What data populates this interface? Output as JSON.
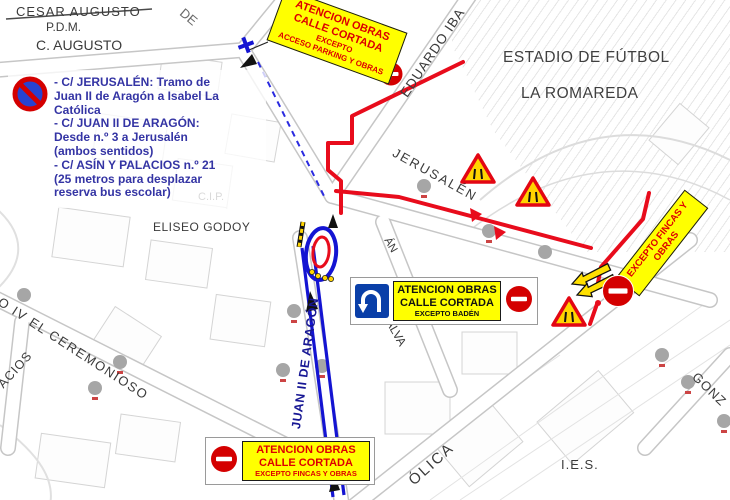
{
  "legend": {
    "lines": [
      "- C/ JERUSALÉN: Tramo de",
      "Juan II de Aragón a Isabel La",
      "Católica",
      "- C/ JUAN II DE ARAGÓN:",
      "Desde n.º 3 a Jerusalén",
      "(ambos sentidos)",
      "- C/ ASÍN Y PALACIOS n.º 21",
      "(25 metros para desplazar",
      "reserva bus escolar)"
    ]
  },
  "banners": {
    "top": {
      "line1": "ATENCION OBRAS",
      "line2": "CALLE CORTADA",
      "line3": "EXCEPTO",
      "line4": "ACCESO PARKING Y OBRAS"
    },
    "middle": {
      "line1": "ATENCION OBRAS",
      "line2": "CALLE CORTADA",
      "line3": "EXCEPTO BADÉN"
    },
    "bottom": {
      "line1": "ATENCION OBRAS",
      "line2": "CALLE CORTADA",
      "line3": "EXCEPTO FINCAS Y OBRAS"
    },
    "right": {
      "line1": "EXCEPTO FINCAS Y",
      "line2": "OBRAS"
    }
  },
  "map_labels": {
    "cesar_augusto": "CESAR AUGUSTO",
    "pdm": "P.D.M.",
    "c_augusto": "C. AUGUSTO",
    "de_fragment": "DE",
    "eduardo_ibarra": "EDUARDO IBA",
    "estadio_line1": "ESTADIO DE FÚTBOL",
    "estadio_line2": "LA ROMAREDA",
    "jerusalen": "JERUSALÉN",
    "cip": "C.I.P.",
    "eliseo_godoy": "ELISEO GODOY",
    "ceremonioso": "O IV EL CEREMONIOSO",
    "palacios": "ACIOS",
    "juan_ii": "JUAN II DE ARAGÓN",
    "alva": "ALVA",
    "azan": "ÁN",
    "catolica": "ÓLICA",
    "ies": "I.E.S.",
    "gonzalez": "GONZ"
  },
  "icons": {
    "no_parking": "no-parking-sign",
    "no_entry": "no-entry-sign",
    "u_turn": "u-turn-left-sign",
    "road_narrows": "road-narrows-warning-triangle",
    "detour": "detour-arrows"
  },
  "colors": {
    "closure_line_red": "#e80c1c",
    "route_blue": "#1414d2",
    "banner_yellow": "#ffff00",
    "banner_text_red": "#dd0000",
    "banner_text_black": "#111111",
    "legend_text_blue": "#3434a4",
    "no_entry_red": "#d40000",
    "uturn_sign_blue": "#0a3fa8",
    "warning_fill": "#ffd400",
    "map_label_gray": "#3b3b3b"
  }
}
